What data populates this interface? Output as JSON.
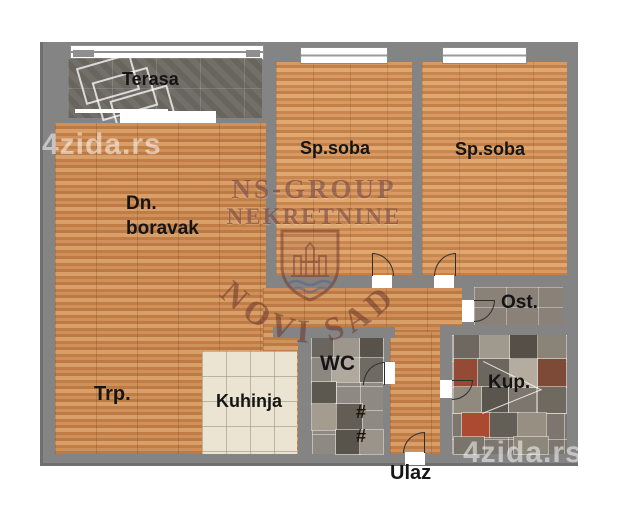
{
  "watermarks": {
    "site_left": "4zida.rs",
    "site_bottom_right": "4zida.rs",
    "agency_name": "NS-GROUP",
    "agency_type": "NEKRETNINE",
    "agency_city": "NOVI SAD"
  },
  "rooms": {
    "terrace": "Terasa",
    "living_line1": "Dn.",
    "living_line2": "boravak",
    "bedroom_mid": "Sp.soba",
    "bedroom_right": "Sp.soba",
    "dining": "Trp.",
    "kitchen": "Kuhinja",
    "storage": "Ost.",
    "wc": "WC",
    "bathroom": "Kup.",
    "entrance": "Ulaz",
    "stair_mark_1": "#",
    "stair_mark_2": "#"
  },
  "colors": {
    "background": "#ffffff",
    "wall": "#848484",
    "wood_floor": "#c5854f",
    "terrace_tile": "#6e6a64",
    "kitchen_tile": "#ebe4d2",
    "wc_tile": "#8e8983",
    "bathroom_tile": "#7c766f",
    "storage_tile": "#8a8178",
    "bath_accent_red": "#a54a33",
    "label_text": "#151515",
    "watermark_site": "rgba(255,255,255,0.52)",
    "watermark_agency": "rgba(106,54,46,0.58)"
  }
}
